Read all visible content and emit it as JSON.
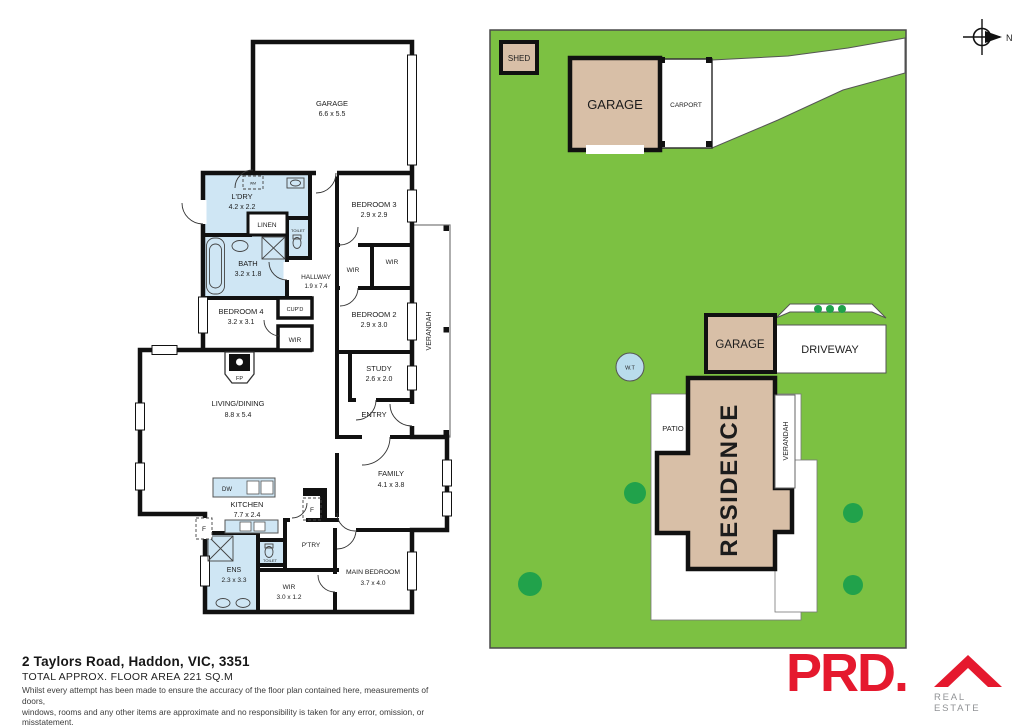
{
  "compass": {
    "label": "N"
  },
  "floorplan": {
    "rooms": [
      {
        "label": "GARAGE",
        "dims": "6.6 x 5.5"
      },
      {
        "label": "L'DRY",
        "dims": "4.2 x 2.2"
      },
      {
        "label": "LINEN"
      },
      {
        "label": "TOILET"
      },
      {
        "label": "BATH",
        "dims": "3.2 x 1.8"
      },
      {
        "label": "HALLWAY",
        "dims": "1.9 x 7.4"
      },
      {
        "label": "BEDROOM 3",
        "dims": "2.9 x 2.9"
      },
      {
        "label": "WIR"
      },
      {
        "label": "WIR"
      },
      {
        "label": "BEDROOM 4",
        "dims": "3.2 x 3.1"
      },
      {
        "label": "CUP'D"
      },
      {
        "label": "WIR"
      },
      {
        "label": "BEDROOM 2",
        "dims": "2.9 x 3.0"
      },
      {
        "label": "STUDY",
        "dims": "2.6 x 2.0"
      },
      {
        "label": "ENTRY"
      },
      {
        "label": "VERANDAH"
      },
      {
        "label": "LIVING/DINING",
        "dims": "8.8 x 5.4"
      },
      {
        "label": "FP"
      },
      {
        "label": "FAMILY",
        "dims": "4.1 x 3.8"
      },
      {
        "label": "KITCHEN",
        "dims": "7.7 x 2.4"
      },
      {
        "label": "DW"
      },
      {
        "label": "F"
      },
      {
        "label": "F"
      },
      {
        "label": "P'TRY"
      },
      {
        "label": "ENS",
        "dims": "2.3 x 3.3"
      },
      {
        "label": "TOILET"
      },
      {
        "label": "WIR",
        "dims": "3.0 x 1.2"
      },
      {
        "label": "MAIN BEDROOM",
        "dims": "3.7 x 4.0"
      },
      {
        "label": "WM"
      }
    ]
  },
  "siteplan": {
    "shed": "SHED",
    "garage_top": "GARAGE",
    "carport": "CARPORT",
    "garage_mid": "GARAGE",
    "driveway": "DRIVEWAY",
    "water_tank": "W.T",
    "residence": "RESIDENCE",
    "patio": "PATIO",
    "verandah": "VERANDAH"
  },
  "footer": {
    "address": "2 Taylors Road, Haddon, VIC, 3351",
    "floor_area": "TOTAL APPROX. FLOOR AREA 221 SQ.M",
    "disclaimer_line1": "Whilst every attempt has been made to ensure the accuracy of the floor plan contained here, measurements of doors,",
    "disclaimer_line2": "windows, rooms and any other items are approximate and no responsibility is taken for any error, omission, or misstatement.",
    "disclaimer_line3": "This plan is for illustrative purposes only and should be used as such by any prospective purchaser."
  },
  "logo": {
    "brand": "PRD.",
    "tagline": "REAL ESTATE"
  },
  "colors": {
    "grass": "#7cc142",
    "tree_green": "#21a24b",
    "building_tan": "#d8bfa7",
    "wet_area_blue": "#cfe6f4",
    "wall_black": "#111111",
    "brand_red": "#e5192e"
  }
}
